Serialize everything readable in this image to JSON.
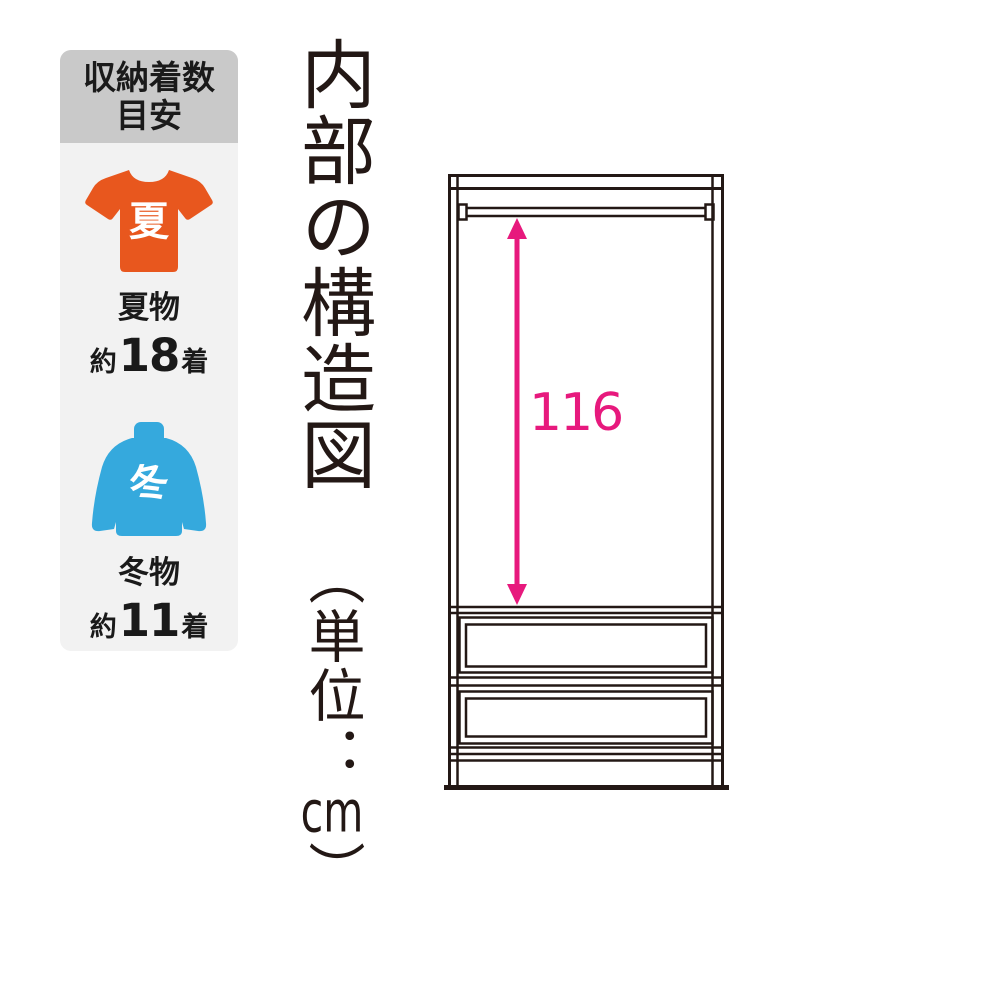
{
  "sidebar": {
    "header": {
      "line1": "収納着数",
      "line2": "目安"
    },
    "summer": {
      "badge": "夏",
      "label": "夏物",
      "approx": "約",
      "count": "18",
      "unit": "着"
    },
    "winter": {
      "badge": "冬",
      "label": "冬物",
      "approx": "約",
      "count": "11",
      "unit": "着"
    }
  },
  "title": {
    "main": "内部の構造図",
    "unit_prefix": "（単位：",
    "unit_value": "cm",
    "unit_suffix": "）"
  },
  "diagram": {
    "dimension": "116"
  },
  "colors": {
    "accent_magenta": "#e7197d",
    "summer_orange": "#e8571e",
    "winter_blue": "#35a9dd",
    "line_black": "#231815",
    "header_gray": "#c9c9c9",
    "panel_gray": "#f2f2f2"
  }
}
